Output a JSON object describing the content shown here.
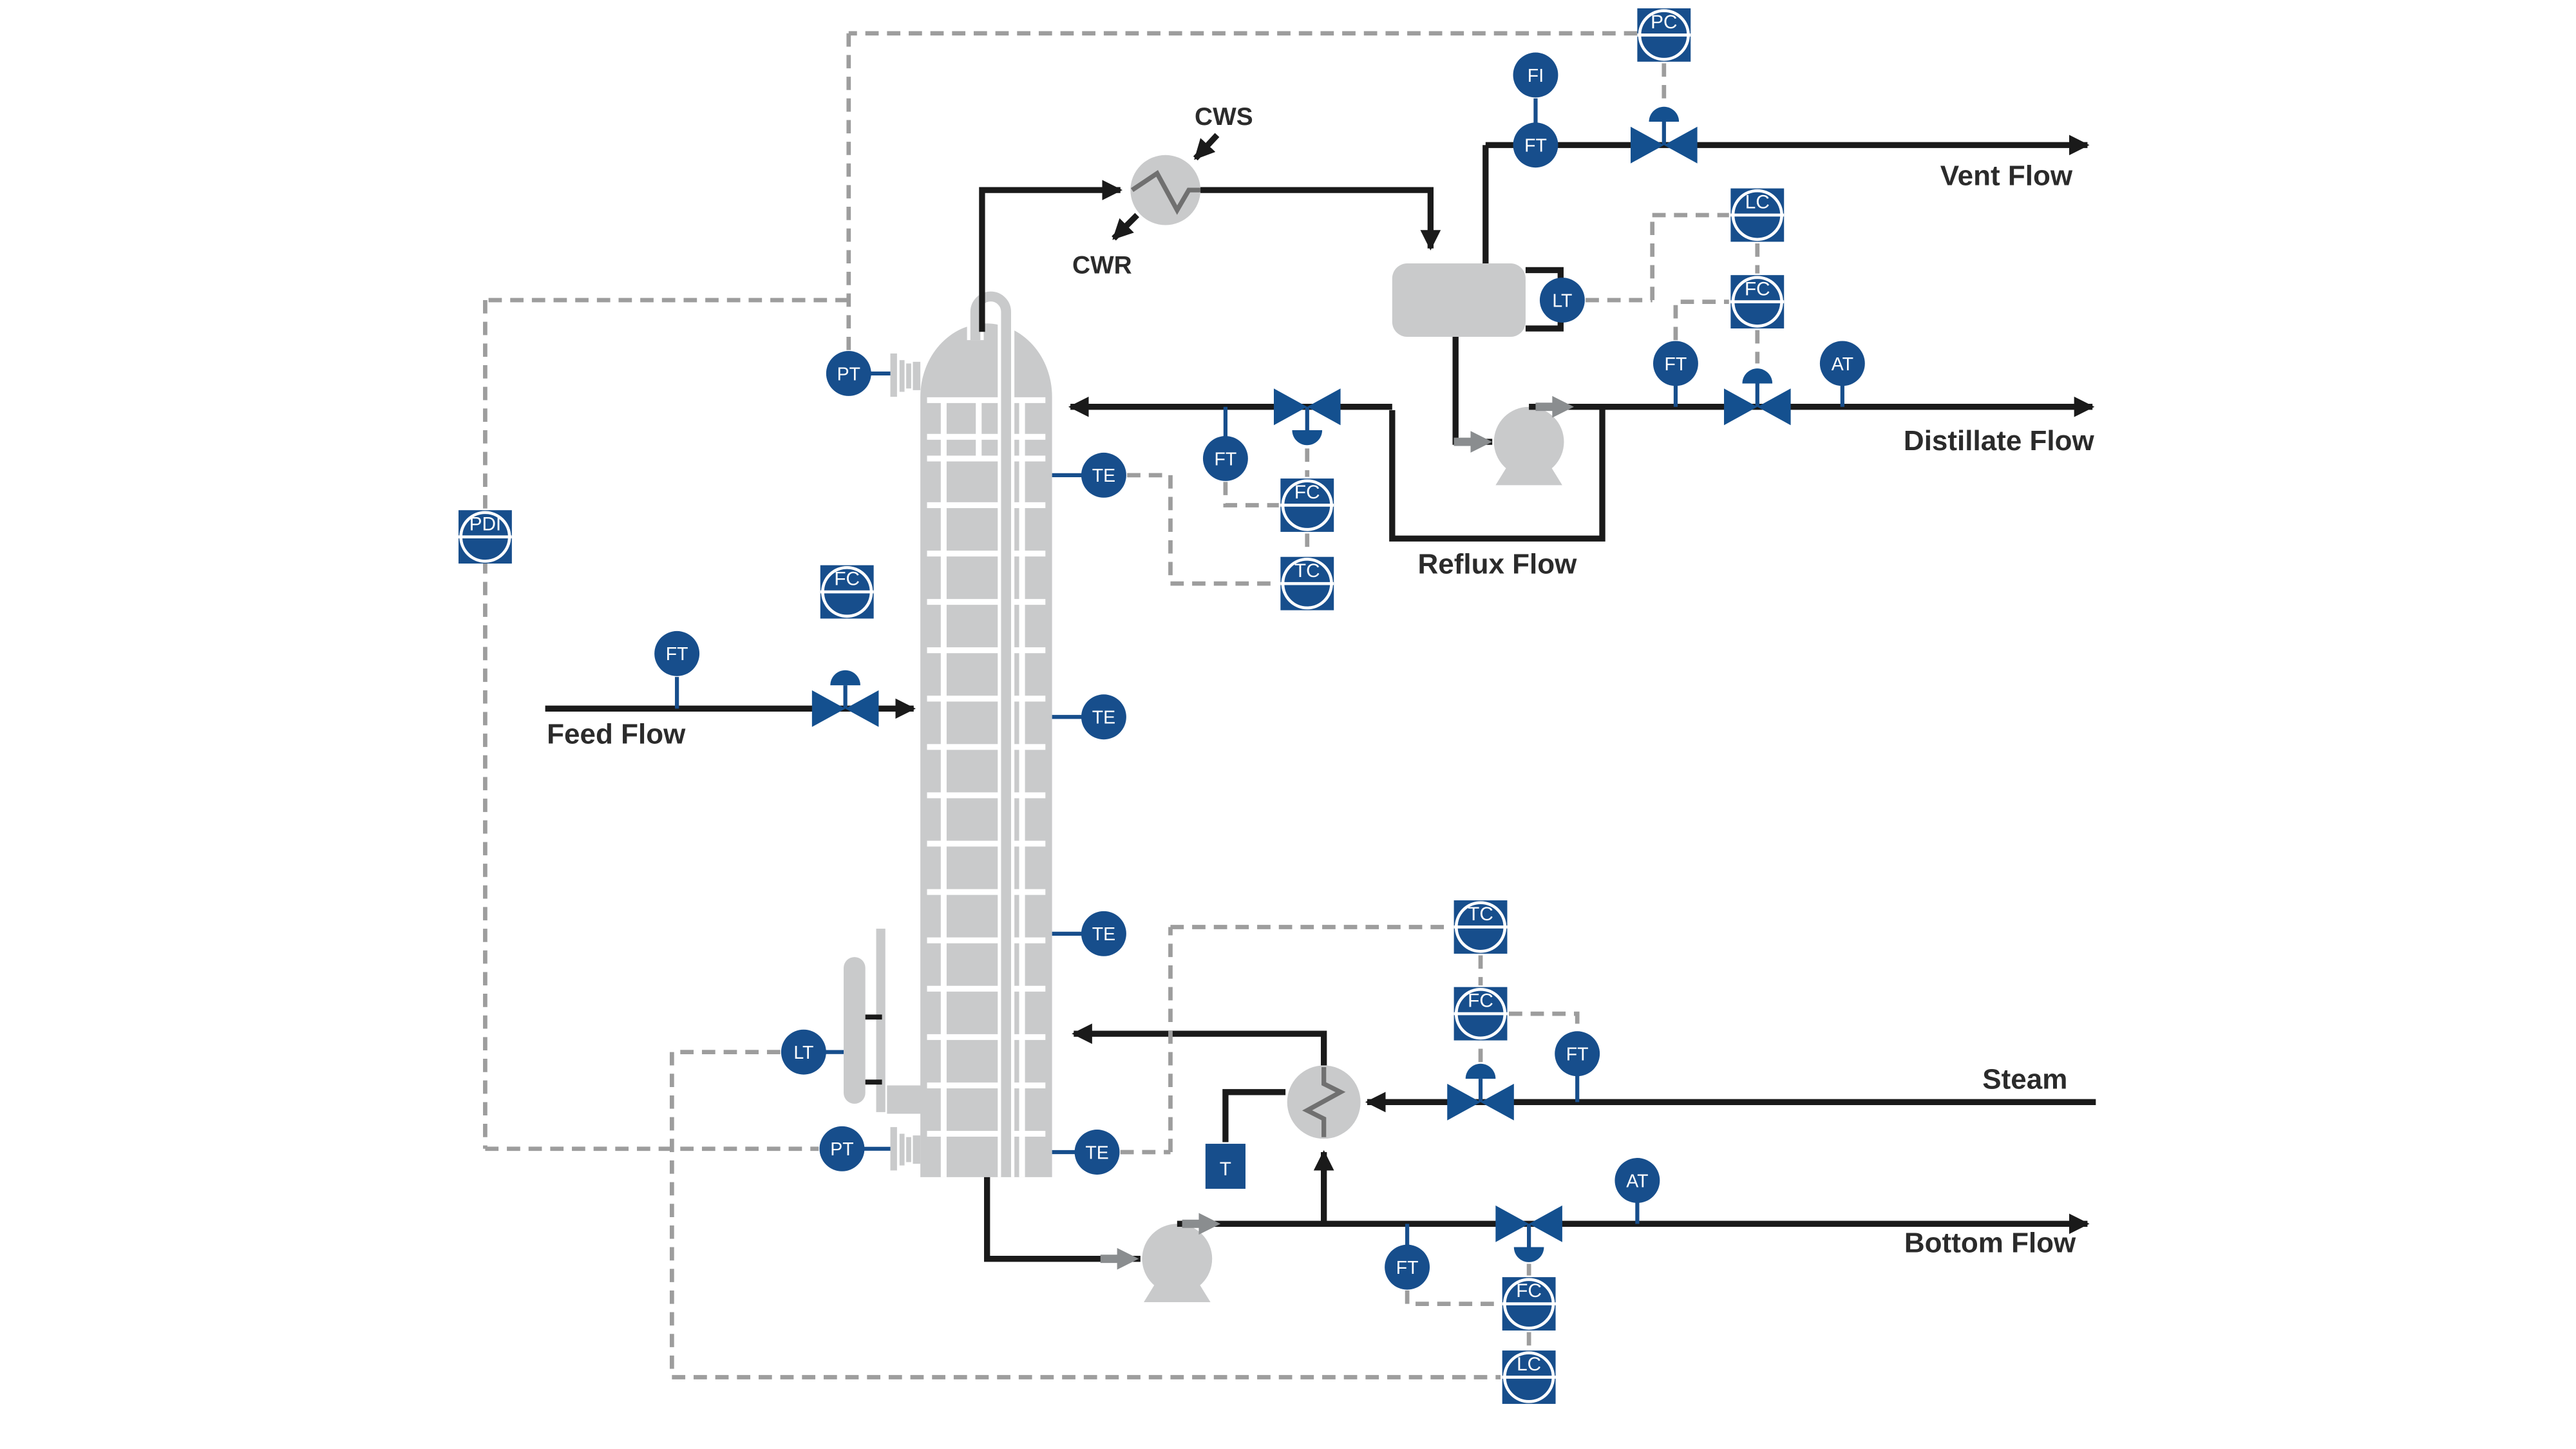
{
  "diagram_type": "P&ID distillation column with control instrumentation",
  "colors": {
    "instrument_blue": "#174e8c",
    "valve_blue": "#14508f",
    "equipment_gray": "#c9cacb",
    "process_line": "#1a1a1a",
    "signal_line": "#9d9d9d",
    "flow_arrow_gray": "#8a8d8f",
    "label_dark": "#2b2b2b"
  },
  "labels": {
    "vent_flow": "Vent Flow",
    "distillate_flow": "Distillate Flow",
    "reflux_flow": "Reflux Flow",
    "feed_flow": "Feed Flow",
    "steam": "Steam",
    "bottom_flow": "Bottom Flow",
    "cws": "CWS",
    "cwr": "CWR"
  },
  "instruments": {
    "pc_vent": "PC",
    "fi_vent": "FI",
    "ft_vent": "FT",
    "lt_drum": "LT",
    "lc_distillate": "LC",
    "fc_distillate": "FC",
    "ft_distillate": "FT",
    "at_distillate": "AT",
    "ft_reflux": "FT",
    "fc_reflux": "FC",
    "tc_reflux": "TC",
    "te_1": "TE",
    "te_2": "TE",
    "te_3": "TE",
    "te_4": "TE",
    "pt_top": "PT",
    "pdi": "PDI",
    "fc_feed": "FC",
    "ft_feed": "FT",
    "lt_bottom": "LT",
    "pt_bottom": "PT",
    "tc_steam": "TC",
    "fc_steam": "FC",
    "ft_steam": "FT",
    "t_reboiler": "T",
    "at_bottom": "AT",
    "ft_bottom": "FT",
    "fc_bottom": "FC",
    "lc_bottom": "LC"
  }
}
